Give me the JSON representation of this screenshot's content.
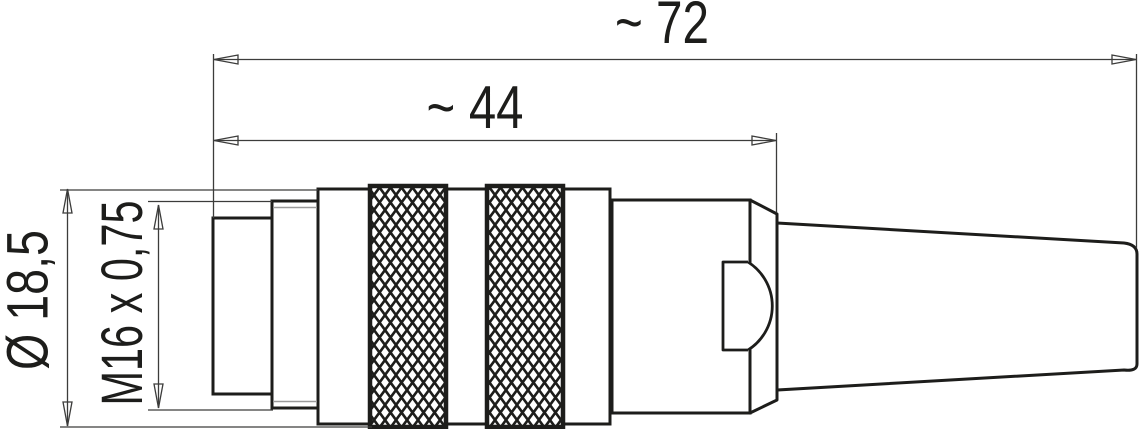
{
  "drawing": {
    "type": "technical-dimension-drawing",
    "subject": "M16 circular cable connector, male, side view",
    "labels": {
      "overall_length": "~ 72",
      "front_length": "~ 44",
      "outer_diameter": "Ø 18,5",
      "thread_spec": "M16 x 0,75"
    },
    "dimensions": {
      "overall_length_mm": 72,
      "overall_length_approx": true,
      "front_length_mm": 44,
      "front_length_approx": true,
      "outer_diameter_mm": 18.5,
      "thread": "M16 x 0.75"
    },
    "colors": {
      "outline": "#1d1d1b",
      "thin_line": "#3c3c3b",
      "inner_gray_line": "#9a9a9a",
      "centerline": "#8a8a8a",
      "background": "#ffffff"
    }
  }
}
